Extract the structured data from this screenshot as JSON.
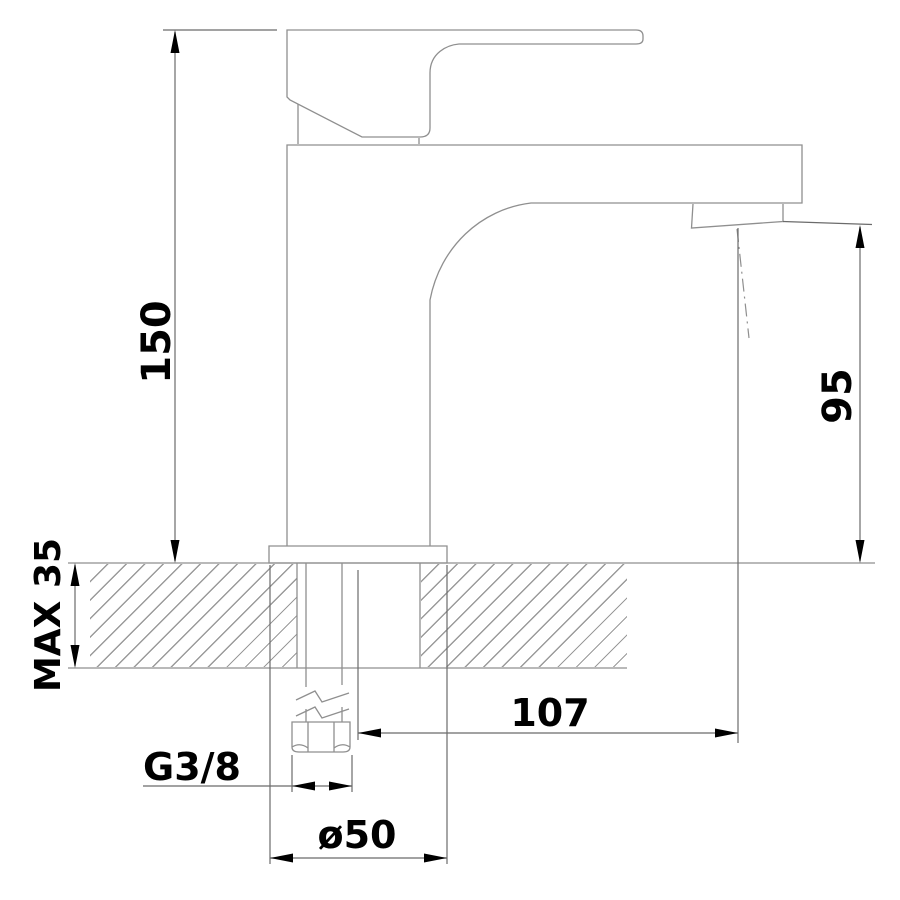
{
  "drawing": {
    "kind": "technical-dimension-drawing",
    "subject": "single-lever basin mixer tap, side view with countertop cross-section",
    "labels": {
      "overall_height": "150",
      "spout_height": "95",
      "max_deck_thickness": "MAX 35",
      "spout_reach": "107",
      "inlet_thread": "G3/8",
      "base_diameter": "ø50"
    },
    "colors": {
      "outline": "#8f8f8f",
      "dimension_line": "#6b6b6b",
      "hatch": "#9a9a9a",
      "text": "#000000",
      "background": "#ffffff"
    }
  }
}
